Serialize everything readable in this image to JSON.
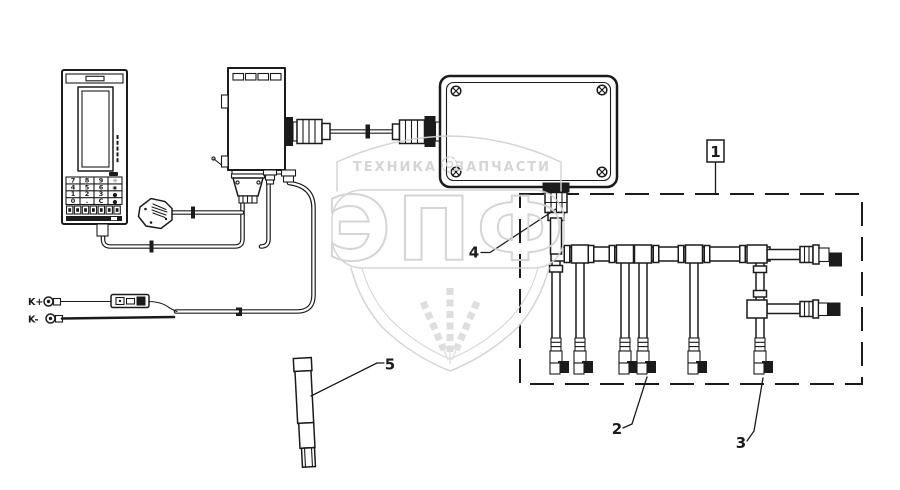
{
  "diagram": {
    "kind": "electrical parts / wiring harness exploded diagram",
    "background": "#ffffff"
  },
  "colors": {
    "line": "#1b1b1b",
    "watermark": "#d2d2d2",
    "background": "#ffffff"
  },
  "watermark": {
    "brand_top_left": "ТЕХНИКА",
    "brand_top_right": "ЗАПЧАСТИ",
    "brand_main": "ЭПФ"
  },
  "battery": {
    "positive_label": "K+",
    "negative_label": "K-"
  },
  "terminal": {
    "keypad_rows": [
      [
        "7",
        "8",
        "9"
      ],
      [
        "4",
        "5",
        "6"
      ],
      [
        "1",
        "2",
        "3"
      ],
      [
        "0",
        ".",
        "C"
      ]
    ],
    "side_keys": [
      "☼",
      "◉",
      "●",
      "●"
    ]
  },
  "callouts": {
    "c1": "1",
    "c2": "2",
    "c3": "3",
    "c4": "4",
    "c5": "5"
  }
}
